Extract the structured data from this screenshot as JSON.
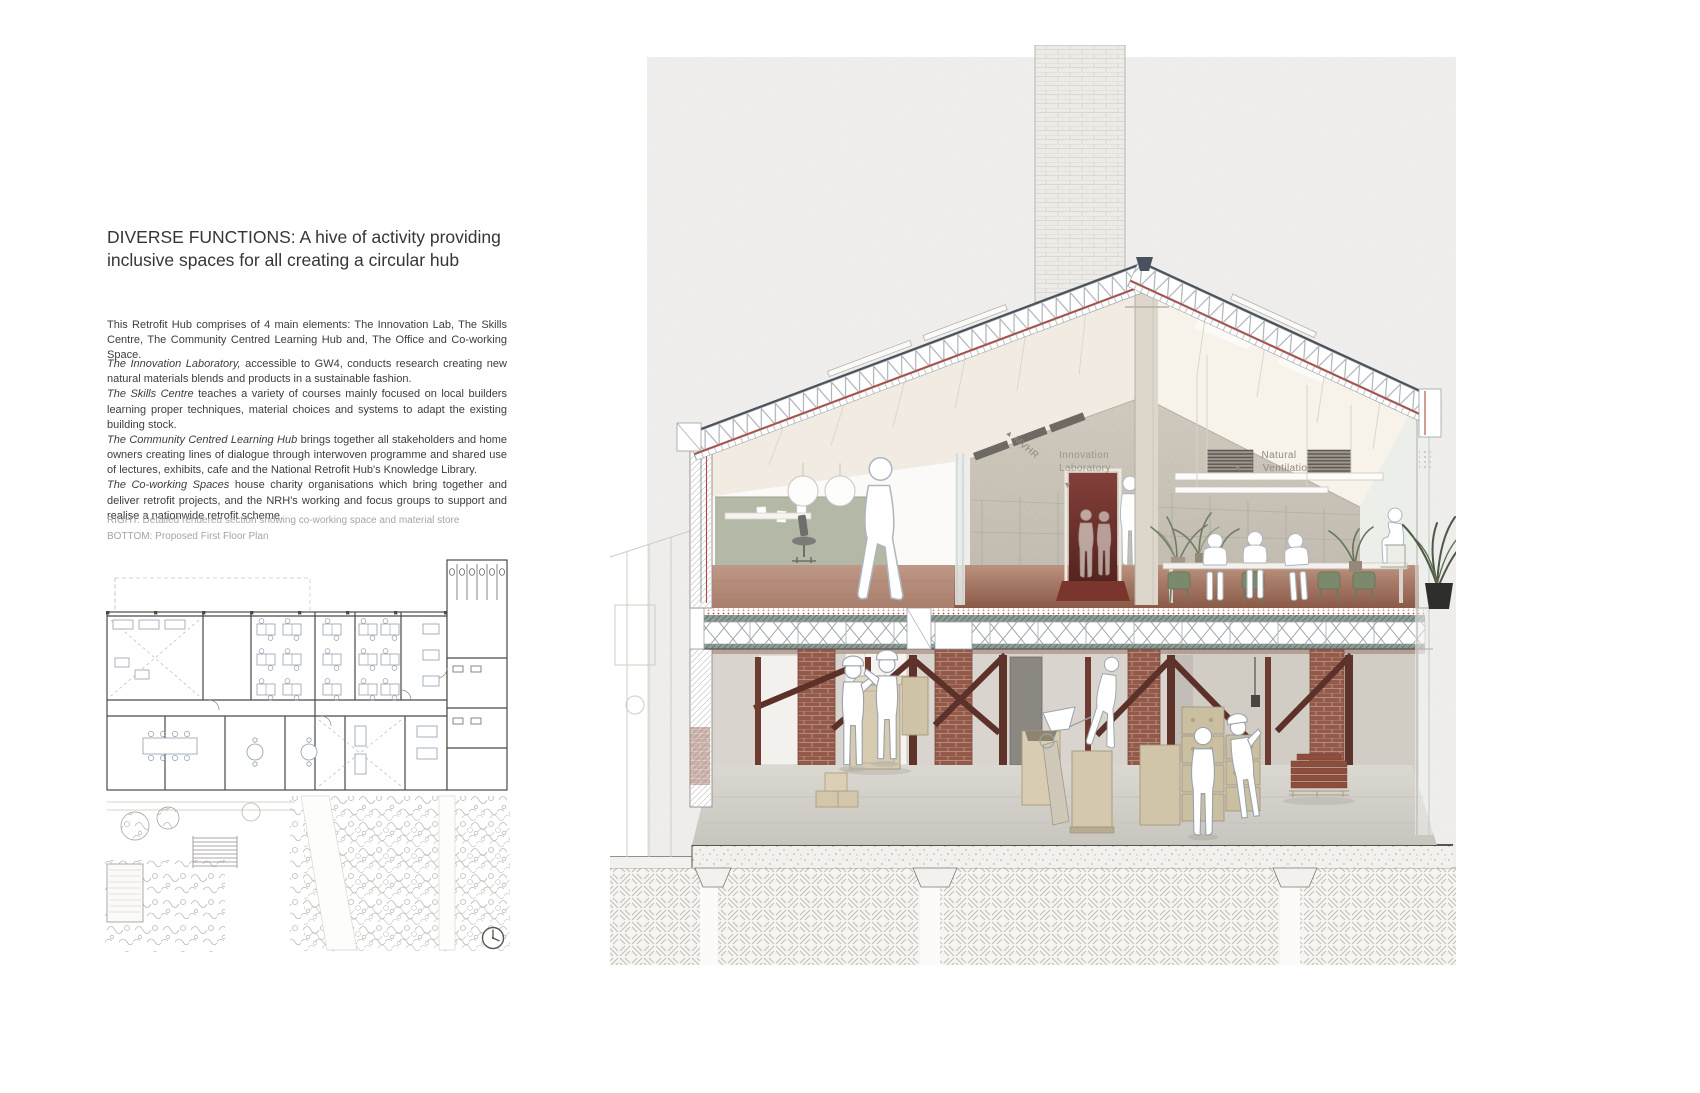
{
  "article": {
    "title": "DIVERSE FUNCTIONS: A hive of activity providing inclusive spaces for all creating a circular hub",
    "intro": "This Retrofit Hub comprises of 4 main elements: The Innovation Lab, The Skills Centre, The Community Centred Learning Hub and, The Office and Co-working Space.",
    "functions": [
      {
        "lead": "The Innovation Laboratory,",
        "rest": " accessible to GW4, conducts research creating new natural materials blends and products in a sustainable fashion."
      },
      {
        "lead": "The Skills Centre",
        "rest": " teaches a variety of courses mainly focused on local builders learning proper techniques, material choices and systems to adapt the existing building stock."
      },
      {
        "lead": "The Community Centred Learning Hub",
        "rest": " brings together all stakeholders and home owners creating lines of dialogue through interwoven programme and shared use of lectures, exhibits, cafe and the National Retrofit Hub's Knowledge Library."
      },
      {
        "lead": "The Co-working Spaces",
        "rest": " house charity organisations which bring together and deliver retrofit projects, and the NRH's working and focus groups to support and realise a nationwide retrofit scheme."
      }
    ],
    "captions": {
      "right": "RIGHT: Detailed rendered section showing co-working space and material store",
      "bottom": "BOTTOM: Proposed First Floor Plan"
    }
  },
  "section_drawing": {
    "labels": {
      "mvhr": "MVHR",
      "mvhr_arrow": "▲",
      "innovation_1": "Innovation",
      "innovation_2": "Laboratory",
      "innovation_arrow": "▼",
      "ventilation_1": "Natural",
      "ventilation_2": "Ventilation",
      "ventilation_arrow": "◄"
    },
    "colors": {
      "accent_red": "#b5483c",
      "terracotta_floor": "#96654f",
      "timber": "#5d332a",
      "brick": "#93594a",
      "chair_green": "#7b8a6d"
    }
  }
}
